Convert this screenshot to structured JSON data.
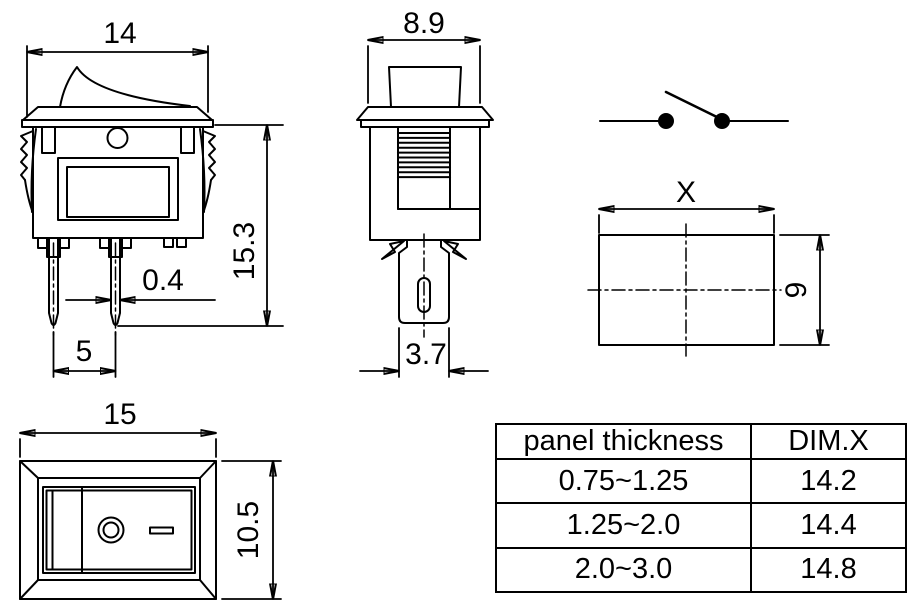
{
  "views": {
    "front": {
      "width": "14",
      "height": "15.3",
      "pin_thickness": "0.4",
      "pin_pitch": "5"
    },
    "side": {
      "depth": "8.9",
      "terminal_width": "3.7"
    },
    "cutout": {
      "width": "X",
      "height": "9"
    },
    "top": {
      "width": "15",
      "height": "10.5"
    }
  },
  "table": {
    "headers": [
      "panel thickness",
      "DIM.X"
    ],
    "rows": [
      [
        "0.75~1.25",
        "14.2"
      ],
      [
        "1.25~2.0",
        "14.4"
      ],
      [
        "2.0~3.0",
        "14.8"
      ]
    ]
  },
  "colors": {
    "line": "#000000",
    "background": "#ffffff"
  }
}
